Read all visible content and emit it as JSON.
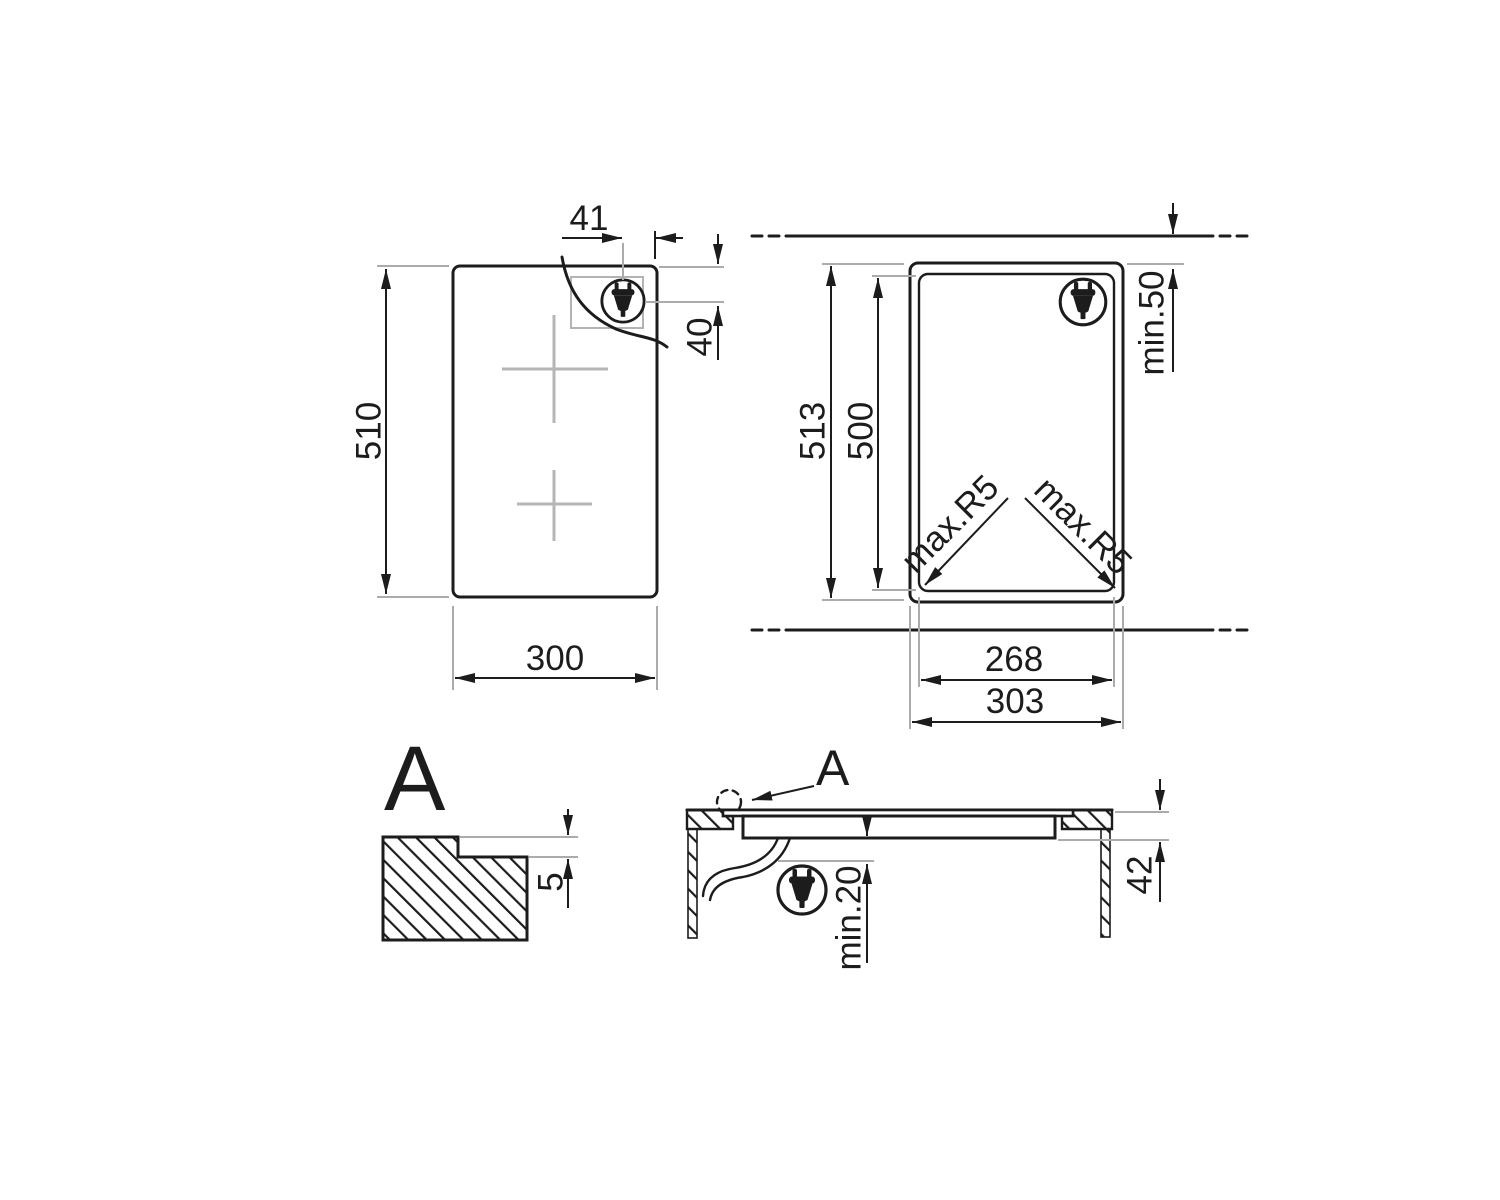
{
  "page": {
    "background": "#ffffff"
  },
  "colors": {
    "line": "#1c1c1c",
    "guide": "#ababab",
    "crosshair": "#b5b5b5"
  },
  "icons": {
    "plug": "power-plug-icon"
  },
  "top_view": {
    "height": "510",
    "width": "300",
    "plug_offset_horizontal": "41",
    "plug_offset_vertical": "40"
  },
  "cutout_view": {
    "overall_height": "513",
    "cutout_height": "500",
    "rear_clearance": "min.50",
    "corner_radius_left": "max.R5",
    "corner_radius_right": "max.R5",
    "cutout_width": "268",
    "overall_width": "303"
  },
  "detail_view": {
    "label": "A",
    "rebate_depth": "5"
  },
  "section_view": {
    "detail_reference": "A",
    "clearance_below": "min.20",
    "installation_depth": "42"
  }
}
